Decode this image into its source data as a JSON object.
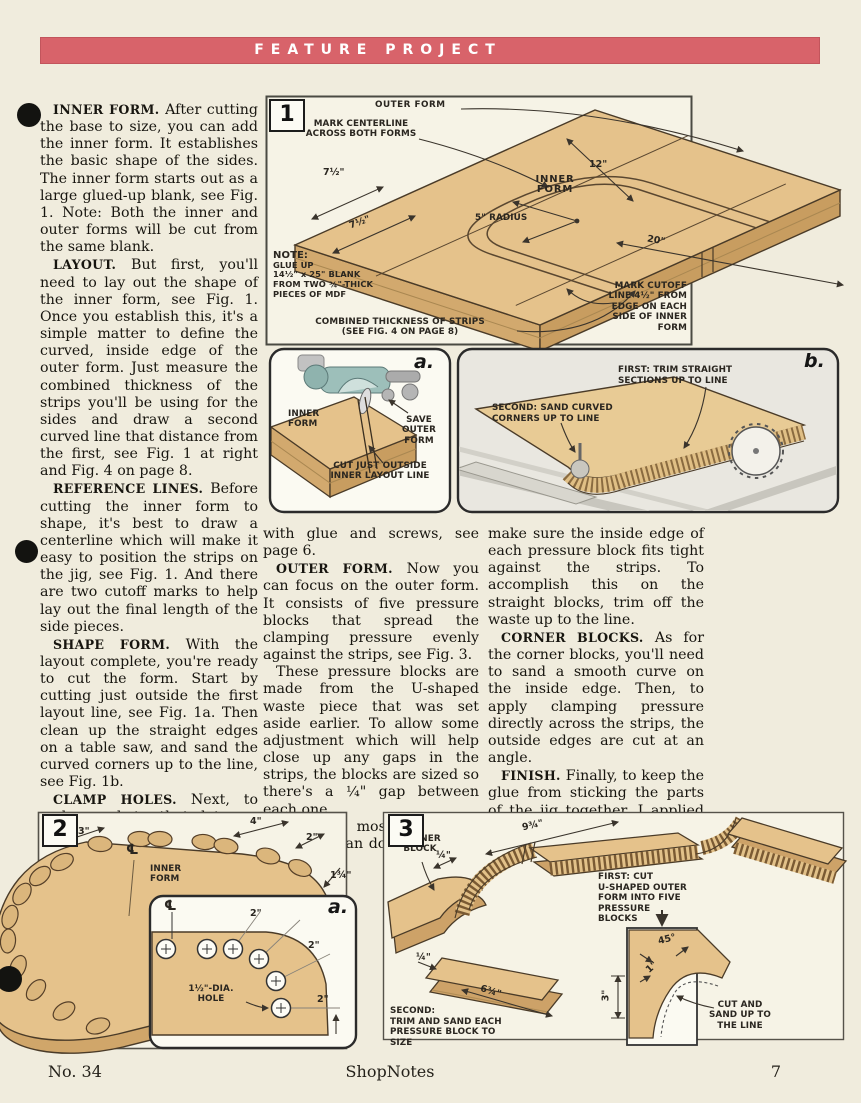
{
  "banner": {
    "title": "FEATURE PROJECT"
  },
  "footer": {
    "issue": "No. 34",
    "magazine": "ShopNotes",
    "page": "7"
  },
  "columns": {
    "left": [
      {
        "lead": "INNER FORM.",
        "text": "After cutting the base to size, you can add the inner form. It establishes the basic shape of the sides. The inner form starts out as a large glued-up blank, see Fig. 1. Note: Both the inner and outer forms will be cut from the same blank."
      },
      {
        "lead": "LAYOUT.",
        "text": "But first, you'll need to lay out the shape of the inner form, see Fig. 1. Once you establish this, it's a simple matter to define the curved, inside edge of the outer form. Just measure the combined thickness of the strips you'll be using for the sides and draw a second curved line that distance from the first, see Fig. 1 at right and Fig. 4 on page 8."
      },
      {
        "lead": "REFERENCE LINES.",
        "text": "Before cutting the inner form to shape, it's best to draw a centerline which will make it easy to position the strips on the jig, see Fig. 1. And there are two cutoff marks to help lay out the final length of the side pieces."
      },
      {
        "lead": "SHAPE FORM.",
        "text": "With the layout complete, you're ready to cut the form. Start by cutting just outside the first layout line, see Fig. 1a. Then clean up the straight edges on a table saw, and sand the curved corners up to the line, see Fig. 1b."
      },
      {
        "lead": "CLAMP HOLES.",
        "text": "Next, to make pockets that let you “hook” the clamps onto the inner form, you'll need to drill holes around the perimeter, see Fig. 2. Then attach the inner form to the base"
      }
    ],
    "middle": [
      {
        "lead": "",
        "text": "with glue and screws, see page 6."
      },
      {
        "lead": "OUTER FORM.",
        "text": "Now you can focus on the outer form. It consists of five pressure blocks that spread the clamping pressure evenly against the strips, see Fig. 3."
      },
      {
        "lead": "",
        "text": "These pressure blocks are made from the U-shaped waste piece that was set aside earlier. To allow some adjustment which will help close up any gaps in the strips, the blocks are sized so there's a ¼\" gap between each one."
      },
      {
        "lead": "",
        "text": "But the most important thing you can do to eliminate gaps is to"
      }
    ],
    "right": [
      {
        "lead": "",
        "text": "make sure the inside edge of each pressure block fits tight against the strips. To accomplish this on the straight blocks, trim off the waste up to the line."
      },
      {
        "lead": "CORNER BLOCKS.",
        "text": "As for the corner blocks, you'll need to sand a smooth curve on the inside edge. Then, to apply clamping pressure directly across the strips, the outside edges are cut at an angle."
      },
      {
        "lead": "FINISH.",
        "text": "Finally, to keep the glue from sticking the parts of the jig together, I applied two coats of varnish and then waxed the form."
      }
    ]
  },
  "fig1": {
    "number": "1",
    "outer_form": "OUTER FORM",
    "mark_centerline": "MARK CENTERLINE\nACROSS BOTH FORMS",
    "dim_7a": "7½\"",
    "dim_7b": "7½\"",
    "inner_form": "INNER\nFORM",
    "dim_12": "12\"",
    "radius": "5\" RADIUS",
    "dim_20": "20\"",
    "note_lead": "NOTE:",
    "note_body": "GLUE UP\n14½\" x 25\" BLANK\nFROM TWO ¾\"-THICK\nPIECES OF MDF",
    "mark_cutoff": "MARK CUTOFF\nLINE 4½\" FROM\nEDGE ON EACH\nSIDE OF INNER FORM",
    "combined": "COMBINED THICKNESS OF STRIPS\n(SEE FIG. 4 ON PAGE 8)"
  },
  "figa": {
    "letter": "a.",
    "inner_form": "INNER\nFORM",
    "save_outer": "SAVE\nOUTER\nFORM",
    "cut_outside": "CUT JUST OUTSIDE\nINNER LAYOUT LINE"
  },
  "figb": {
    "letter": "b.",
    "first_lead": "FIRST:",
    "first_text": "TRIM STRAIGHT\nSECTIONS UP TO LINE",
    "second_lead": "SECOND:",
    "second_text": "SAND CURVED\nCORNERS UP TO LINE"
  },
  "fig2": {
    "number": "2",
    "dim_3": "3\"",
    "dim_4": "4\"",
    "dim_2": "2\"",
    "dim_134": "1¾\"",
    "cl": "℄",
    "inner_form": "INNER\nFORM"
  },
  "fig2a": {
    "letter": "a.",
    "cl": "℄",
    "dim_2a": "2\"",
    "dim_2b": "2\"",
    "dim_2c": "2\"",
    "hole": "1½\"-DIA.\nHOLE"
  },
  "fig3": {
    "number": "3",
    "corner_block": "CORNER\nBLOCK",
    "dim_q1": "¼\"",
    "dim_934": "9¾\"",
    "first_lead": "FIRST:",
    "first_text": "CUT\nU-SHAPED OUTER\nFORM INTO FIVE\nPRESSURE BLOCKS",
    "dim_q2": "¼\"",
    "dim_634": "6¾\"",
    "second_lead": "SECOND:",
    "second_text": "TRIM AND SAND EACH\nPRESSURE BLOCK TO SIZE",
    "dim_3in": "3\"",
    "dim_45": "45°",
    "dim_1": "1\"",
    "cut_sand": "CUT AND\nSAND UP TO\nTHE LINE"
  }
}
